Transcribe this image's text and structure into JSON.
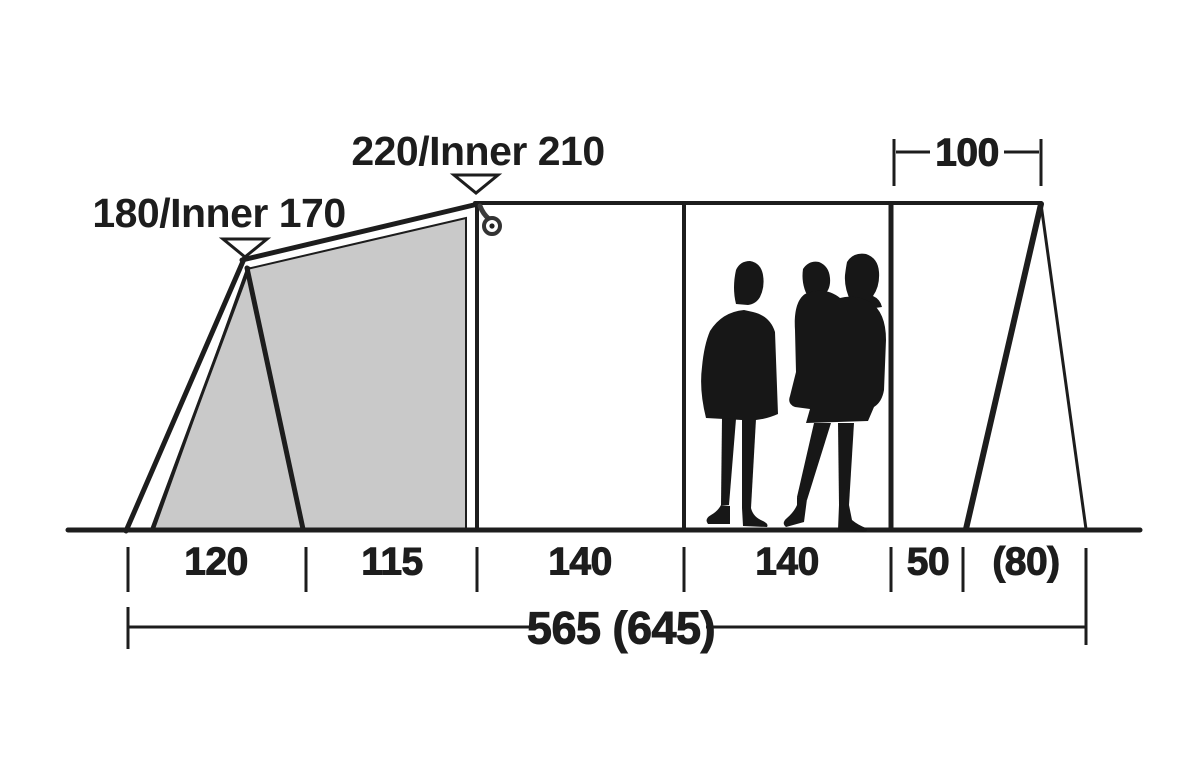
{
  "colors": {
    "ink": "#1d1d1d",
    "panel": "#c9c9c9",
    "silhouette": "#171717",
    "background": "#ffffff"
  },
  "annotations": {
    "peak_front": "180/Inner 170",
    "peak_main": "220/Inner 210",
    "porch_width": "100",
    "total_length": "565 (645)"
  },
  "sections": [
    {
      "label": "120"
    },
    {
      "label": "115"
    },
    {
      "label": "140"
    },
    {
      "label": "140"
    },
    {
      "label": "50"
    },
    {
      "label": "(80)"
    }
  ],
  "icons": {
    "lantern_hook": "hanging-ring",
    "height_marker": "open-down-triangle"
  }
}
